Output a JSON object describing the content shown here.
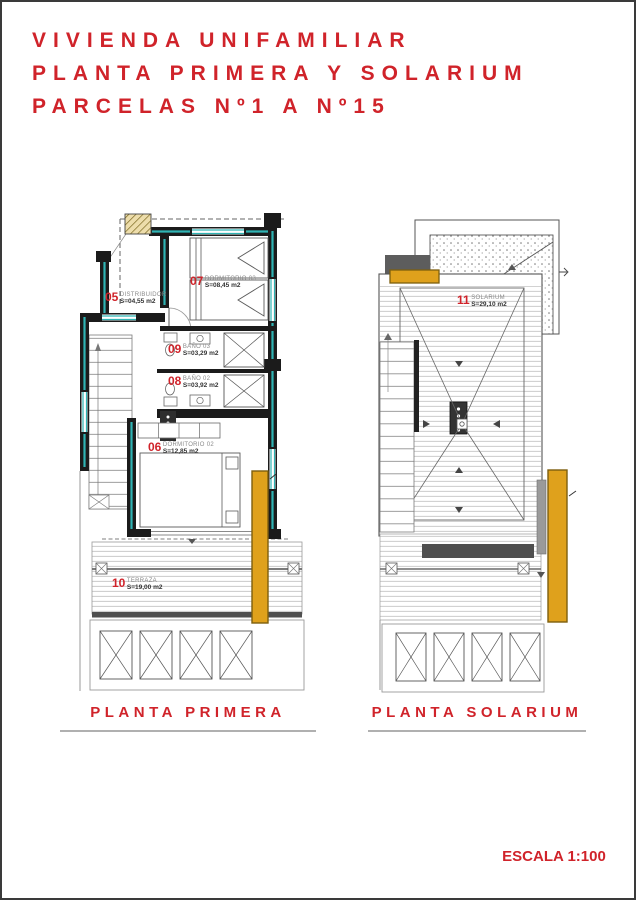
{
  "page": {
    "title_lines": [
      "VIVIENDA UNIFAMILIAR",
      "PLANTA PRIMERA Y SOLARIUM",
      "PARCELAS Nº1 A Nº15"
    ],
    "scale_label": "ESCALA 1:100",
    "colors": {
      "accent_red": "#d0232a",
      "insulation_teal": "#2fb3b3",
      "awning_yellow": "#dfa11c",
      "wall_black": "#1b1b1b",
      "concrete_gray": "#5d5d5d"
    }
  },
  "plans": {
    "primera": {
      "caption": "PLANTA PRIMERA",
      "rooms": [
        {
          "number": "05",
          "name": "DISTRIBUIDOR",
          "area": "S=04,55 m2"
        },
        {
          "number": "07",
          "name": "DORMITORIO 03",
          "area": "S=08,45 m2"
        },
        {
          "number": "09",
          "name": "BAÑO 03",
          "area": "S=03,29 m2"
        },
        {
          "number": "08",
          "name": "BAÑO 02",
          "area": "S=03,92 m2"
        },
        {
          "number": "06",
          "name": "DORMITORIO 02",
          "area": "S=12,85 m2"
        },
        {
          "number": "10",
          "name": "TERRAZA",
          "area": "S=19,00 m2"
        }
      ]
    },
    "solarium": {
      "caption": "PLANTA SOLARIUM",
      "rooms": [
        {
          "number": "11",
          "name": "SOLARIUM",
          "area": "S=29,10 m2"
        }
      ]
    }
  }
}
